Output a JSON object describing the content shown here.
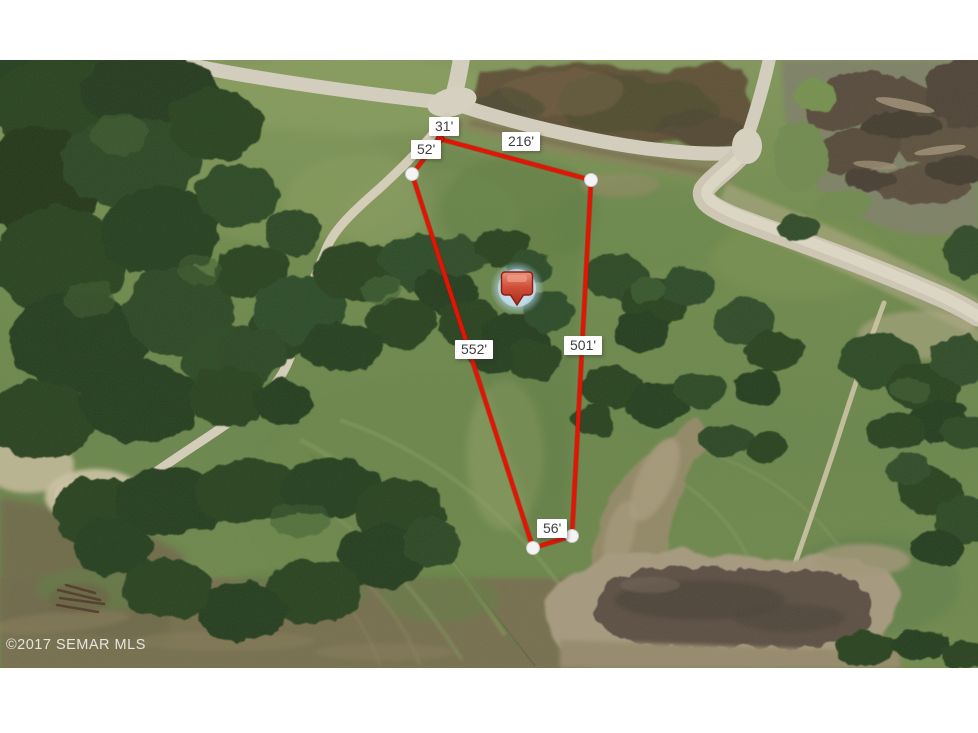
{
  "map": {
    "watermark": {
      "text": "©2017 SEMAR MLS"
    },
    "measurements": [
      {
        "name": "north-jog",
        "text": "31'"
      },
      {
        "name": "northwest-side",
        "text": "52'"
      },
      {
        "name": "north-side",
        "text": "216'"
      },
      {
        "name": "southwest-side",
        "text": "552'"
      },
      {
        "name": "east-side",
        "text": "501'"
      },
      {
        "name": "south-side",
        "text": "56'"
      }
    ],
    "marker": {
      "icon": "location-pin",
      "color": "#c23a24"
    },
    "colors": {
      "boundary_line": "#e21405",
      "vertex_dot": "#f4f4f4",
      "label_background": "#ffffff",
      "label_text": "#3f3f3f",
      "pin_glow": "#cfe4f2",
      "photo_matte": "#ffffff"
    }
  }
}
